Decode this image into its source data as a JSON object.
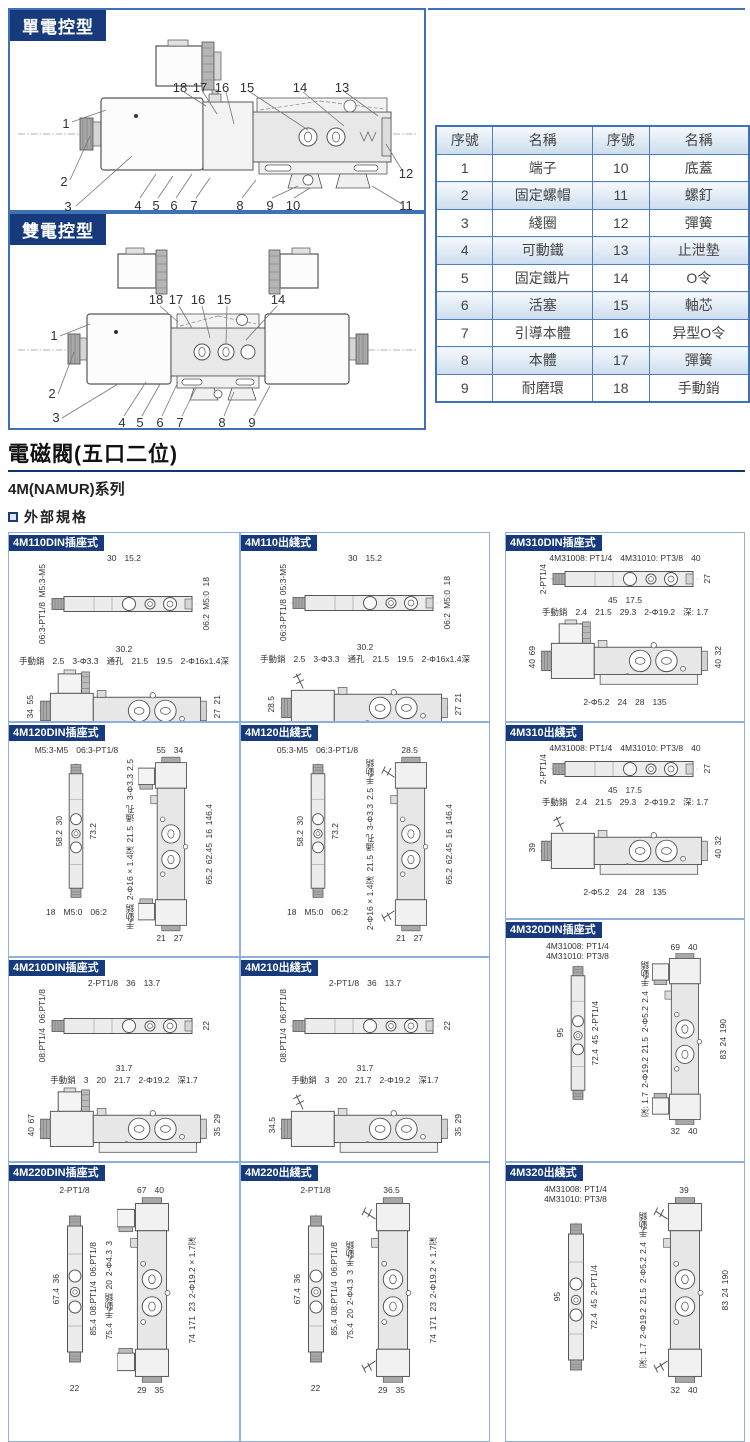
{
  "page": {
    "sections": {
      "single": {
        "label": "單電控型",
        "callouts": {
          "top": [
            "18",
            "17",
            "16",
            "15",
            "14",
            "13"
          ],
          "left": [
            "1",
            "2",
            "3"
          ],
          "bottom": [
            "4",
            "5",
            "6",
            "7",
            "8",
            "9",
            "10"
          ],
          "right": [
            "12",
            "11"
          ]
        }
      },
      "double": {
        "label": "雙電控型",
        "callouts": {
          "top": [
            "18",
            "17",
            "16",
            "15",
            "14"
          ],
          "left": [
            "1",
            "2",
            "3"
          ],
          "bottom": [
            "4",
            "5",
            "6",
            "7",
            "8",
            "9"
          ]
        }
      }
    },
    "parts_table": {
      "headers": [
        "序號",
        "名稱",
        "序號",
        "名稱"
      ],
      "rows": [
        [
          "1",
          "端子",
          "10",
          "底蓋"
        ],
        [
          "2",
          "固定螺帽",
          "11",
          "螺釘"
        ],
        [
          "3",
          "綫圈",
          "12",
          "彈簧"
        ],
        [
          "4",
          "可動鐵",
          "13",
          "止泄墊"
        ],
        [
          "5",
          "固定鐵片",
          "14",
          "O令"
        ],
        [
          "6",
          "活塞",
          "15",
          "軸芯"
        ],
        [
          "7",
          "引導本體",
          "16",
          "异型O令"
        ],
        [
          "8",
          "本體",
          "17",
          "彈簧"
        ],
        [
          "9",
          "耐磨環",
          "18",
          "手動銷"
        ]
      ]
    },
    "title": "電磁閥(五口二位)",
    "series": "4M(NAMUR)系列",
    "spec_heading": "外部規格",
    "panels": [
      {
        "title": "4M110DIN插座式",
        "type": "h",
        "view1": {
          "above": [
            "30",
            "15.2"
          ],
          "left": [
            "M5:3-M5",
            "06:3-PT1/8"
          ],
          "right": [
            "18",
            "M5:0",
            "06:2"
          ],
          "below": [
            "30.2"
          ]
        },
        "view2": {
          "above": [
            "手動銷",
            "2.5",
            "3-Φ3.3",
            "通孔",
            "21.5",
            "19.5",
            "2-Φ16x1.4深"
          ],
          "left": [
            "55",
            "34"
          ],
          "right": [
            "21",
            "27"
          ],
          "below": [
            "16",
            "22.2",
            "103.4"
          ]
        }
      },
      {
        "title": "4M110出綫式",
        "type": "h",
        "view1": {
          "above": [
            "30",
            "15.2"
          ],
          "left": [
            "05:3-M5",
            "06:3-PT1/8"
          ],
          "right": [
            "18",
            "M5:0",
            "06:2"
          ],
          "below": [
            "30.2"
          ]
        },
        "view2": {
          "above": [
            "手動銷",
            "2.5",
            "3-Φ3.3",
            "通孔",
            "21.5",
            "19.5",
            "2-Φ16x1.4深"
          ],
          "left": [
            "28.5"
          ],
          "right": [
            "21",
            "27"
          ],
          "below": [
            "16",
            "22.2",
            "103.4"
          ]
        }
      },
      {
        "title": "4M310DIN插座式",
        "type": "h",
        "view1": {
          "above": [
            "4M31008: PT1/4",
            "4M31010: PT3/8",
            "40"
          ],
          "left": [
            "2-PT1/4"
          ],
          "right": [
            "27"
          ],
          "below": [
            "45",
            "17.5"
          ]
        },
        "view2": {
          "above": [
            "手動銷",
            "2.4",
            "21.5",
            "29.3",
            "2-Φ19.2",
            "深: 1.7"
          ],
          "left": [
            "69",
            "40"
          ],
          "right": [
            "32",
            "40"
          ],
          "below": [
            "2-Φ5.2",
            "24",
            "28",
            "135"
          ]
        }
      },
      {
        "title": "4M120DIN插座式",
        "type": "v",
        "view1": {
          "above": [
            "M5:3-M5",
            "06:3-PT1/8"
          ],
          "left": [
            "30",
            "58.2"
          ],
          "right": [
            "73.2"
          ],
          "below": [
            "18",
            "M5:0",
            "06:2"
          ]
        },
        "view2": {
          "above": [
            "55",
            "34"
          ],
          "left": [
            "2.5",
            "3-Φ3.3",
            "通孔",
            "21.5",
            "2-Φ16×1.4深",
            "手動銷"
          ],
          "right": [
            "146.4",
            "16",
            "62.45",
            "65.2"
          ],
          "below": [
            "21",
            "27"
          ]
        }
      },
      {
        "title": "4M120出綫式",
        "type": "v",
        "view1": {
          "above": [
            "05:3-M5",
            "06:3-PT1/8"
          ],
          "left": [
            "30",
            "58.2"
          ],
          "right": [
            "73.2"
          ],
          "below": [
            "18",
            "M5:0",
            "06:2"
          ]
        },
        "view2": {
          "above": [
            "28.5"
          ],
          "left": [
            "手動銷",
            "2.5",
            "3-Φ3.3",
            "通孔",
            "21.5",
            "2-Φ16×1.4深"
          ],
          "right": [
            "146.4",
            "16",
            "62.45",
            "65.2"
          ],
          "below": [
            "21",
            "27"
          ]
        }
      },
      {
        "title": "4M310出綫式",
        "type": "h",
        "view1": {
          "above": [
            "4M31008: PT1/4",
            "4M31010: PT3/8",
            "40"
          ],
          "left": [
            "2-PT1/4"
          ],
          "right": [
            "27"
          ],
          "below": [
            "45",
            "17.5"
          ]
        },
        "view2": {
          "above": [
            "手動銷",
            "2.4",
            "21.5",
            "29.3",
            "2-Φ19.2",
            "深: 1.7"
          ],
          "left": [
            "39"
          ],
          "right": [
            "32",
            "40"
          ],
          "below": [
            "2-Φ5.2",
            "24",
            "28",
            "135"
          ]
        }
      },
      {
        "title": "4M210DIN插座式",
        "type": "h",
        "view1": {
          "above": [
            "2-PT1/8",
            "36",
            "13.7"
          ],
          "left": [
            "06:PT1/8",
            "08:PT1/4"
          ],
          "right": [
            "22"
          ],
          "below": [
            "31.7"
          ]
        },
        "view2": {
          "above": [
            "手動銷",
            "3",
            "20",
            "21.7",
            "2-Φ19.2",
            "深1.7"
          ],
          "left": [
            "67",
            "40"
          ],
          "right": [
            "29",
            "35"
          ],
          "below": [
            "2-Φ4.3",
            "23",
            "20.2",
            "117"
          ]
        }
      },
      {
        "title": "4M210出綫式",
        "type": "h",
        "view1": {
          "above": [
            "2-PT1/8",
            "36",
            "13.7"
          ],
          "left": [
            "06:PT1/8",
            "08:PT1/4"
          ],
          "right": [
            "22"
          ],
          "below": [
            "31.7"
          ]
        },
        "view2": {
          "above": [
            "手動銷",
            "3",
            "20",
            "21.7",
            "2-Φ19.2",
            "深1.7"
          ],
          "left": [
            "34.5"
          ],
          "right": [
            "29",
            "35"
          ],
          "below": [
            "2-Φ4.3",
            "23",
            "20.2",
            "117"
          ]
        }
      },
      {
        "title": "4M320DIN插座式",
        "type": "v",
        "view1": {
          "above": [
            "4M31008: PT1/4",
            "4M31010: PT3/8"
          ],
          "left": [
            "95"
          ],
          "right": [
            "2-PT1/4",
            "45",
            "72.4"
          ],
          "below": []
        },
        "view2": {
          "above": [
            "69",
            "40"
          ],
          "left": [
            "手動銷",
            "2.4",
            "2-Φ5.2",
            "21.5",
            "2-Φ19.2",
            "深: 1.7"
          ],
          "right": [
            "190",
            "24",
            "83"
          ],
          "below": [
            "32",
            "40"
          ]
        }
      },
      {
        "title": "4M220DIN插座式",
        "type": "v",
        "view1": {
          "above": [
            "2-PT1/8"
          ],
          "left": [
            "36",
            "67.4"
          ],
          "right": [
            "06:PT1/8",
            "08:PT1/4",
            "85.4"
          ],
          "below": [
            "22"
          ]
        },
        "view2": {
          "above": [
            "67",
            "40"
          ],
          "left": [
            "3",
            "2-Φ4.3",
            "20",
            "手動銷",
            "75.4"
          ],
          "right": [
            "2-Φ19.2×1.7深",
            "23",
            "171",
            "74"
          ],
          "below": [
            "29",
            "35"
          ]
        }
      },
      {
        "title": "4M220出綫式",
        "type": "v",
        "view1": {
          "above": [
            "2-PT1/8"
          ],
          "left": [
            "36",
            "67.4"
          ],
          "right": [
            "06:PT1/8",
            "08:PT1/4",
            "85.4"
          ],
          "below": [
            "22"
          ]
        },
        "view2": {
          "above": [
            "36.5"
          ],
          "left": [
            "手動銷",
            "3",
            "2-Φ4.3",
            "20",
            "75.4"
          ],
          "right": [
            "2-Φ19.2×1.7深",
            "23",
            "171",
            "74"
          ],
          "below": [
            "29",
            "35"
          ]
        }
      },
      {
        "title": "4M320出綫式",
        "type": "v",
        "view1": {
          "above": [
            "4M31008: PT1/4",
            "4M31010: PT3/8"
          ],
          "left": [
            "95"
          ],
          "right": [
            "2-PT1/4",
            "45",
            "72.4"
          ],
          "below": []
        },
        "view2": {
          "above": [
            "39"
          ],
          "left": [
            "手動銷",
            "2.4",
            "2-Φ5.2",
            "21.5",
            "2-Φ19.2",
            "深: 1.7"
          ],
          "right": [
            "190",
            "24",
            "83"
          ],
          "below": [
            "32",
            "40"
          ]
        }
      }
    ]
  }
}
